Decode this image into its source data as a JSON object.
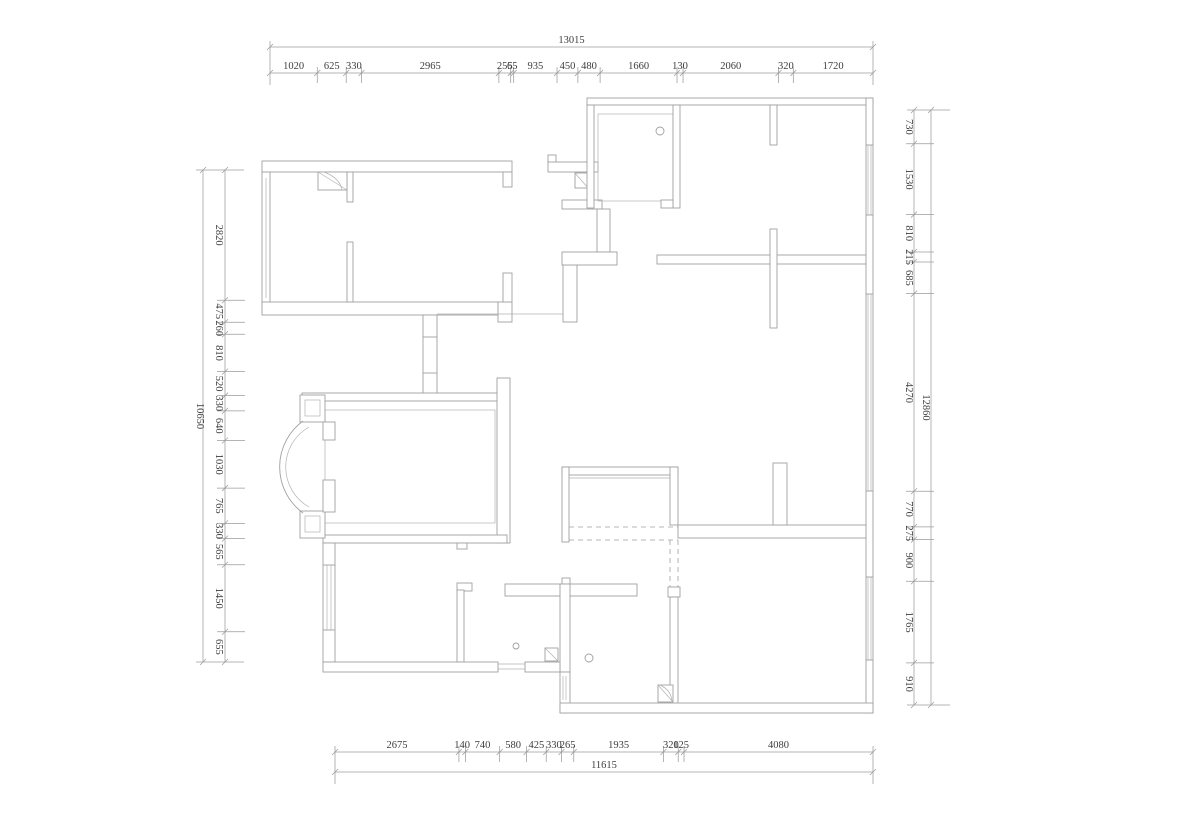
{
  "colors": {
    "background": "#ffffff",
    "wall_line": "#a0a0a0",
    "dimension_line": "#9b9b9b",
    "dimension_text": "#3d3d3d"
  },
  "dimensions": {
    "top": {
      "overall_label": "13015",
      "total": 13015,
      "segments": [
        1020,
        625,
        330,
        2965,
        255,
        65,
        935,
        450,
        480,
        1660,
        130,
        2060,
        320,
        1720
      ]
    },
    "bottom": {
      "overall_label": "11615",
      "total": 11615,
      "segments": [
        2675,
        140,
        740,
        580,
        425,
        330,
        265,
        1935,
        320,
        125,
        4080
      ]
    },
    "left": {
      "overall_label": "10650",
      "total": 10650,
      "segments": [
        2820,
        475,
        260,
        810,
        520,
        330,
        640,
        1030,
        765,
        330,
        565,
        1450,
        655
      ]
    },
    "right": {
      "overall_label": "12860",
      "total": 12860,
      "segments": [
        730,
        1530,
        810,
        215,
        685,
        4270,
        770,
        275,
        900,
        1765,
        910
      ]
    }
  },
  "symbols": {
    "shaft_flue_squares": 4,
    "round_fixtures": 3,
    "bay_window_arcs": 2,
    "dashed_wardrobe_lines": 4
  }
}
